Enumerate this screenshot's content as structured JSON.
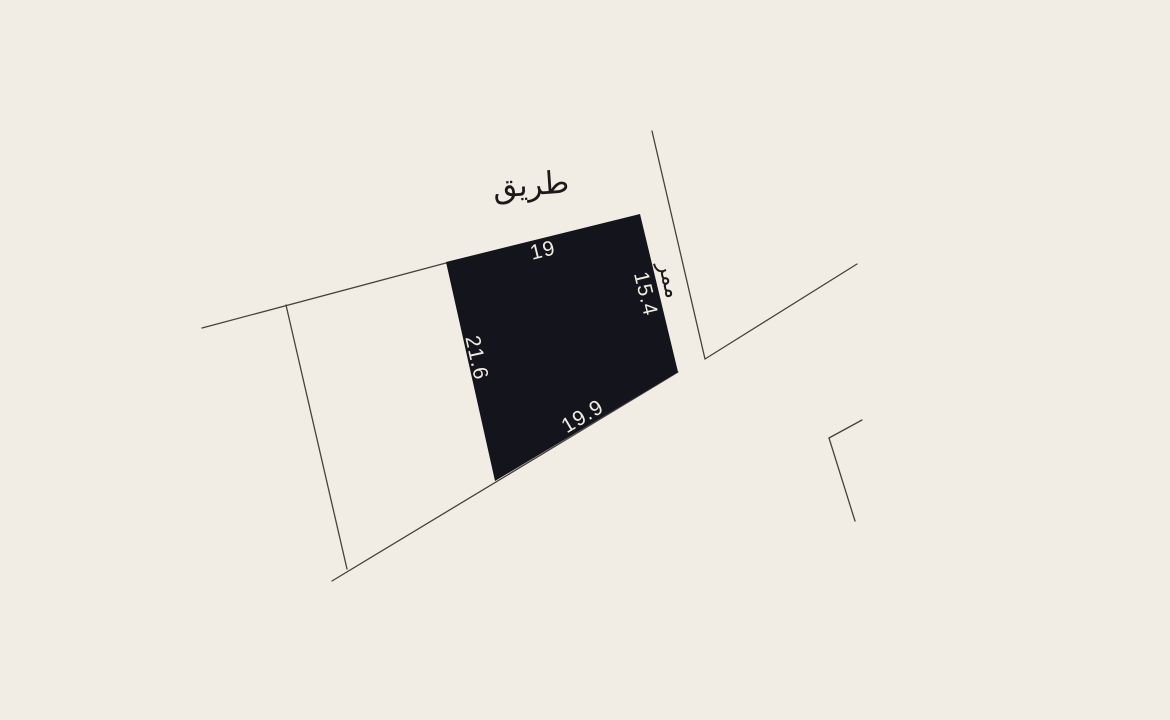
{
  "canvas": {
    "background": "#f2ede4",
    "parcel_fill": "#14141d",
    "line_color": "#46413b",
    "dim_label_color": "#f0ebe2",
    "road_label_color": "#1c1a18"
  },
  "parcel": {
    "dimensions": {
      "top": "19",
      "right": "15.4",
      "left": "21.6",
      "bottom": "19.9"
    }
  },
  "labels": {
    "road": "طريق",
    "passage": "ممر"
  }
}
